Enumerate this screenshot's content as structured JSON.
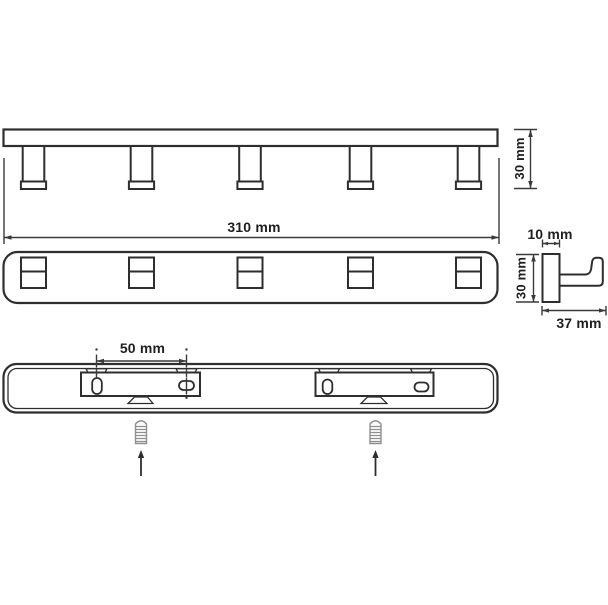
{
  "page": {
    "background": "#ffffff",
    "line_color": "#2e2e2e",
    "text_color": "#1f1f1f",
    "screw_color": "#909090"
  },
  "views": {
    "side": {
      "name": "rail side view with hooks",
      "hook_count": 5,
      "length_label": "310 mm",
      "height_label": "30 mm"
    },
    "front": {
      "name": "rail front view",
      "hook_count": 5
    },
    "hook_profile": {
      "name": "single hook profile",
      "width_label": "10 mm",
      "height_label": "30 mm",
      "depth_label": "37 mm"
    },
    "back": {
      "name": "rail back view with mounting plates",
      "slot_spacing_label": "50 mm",
      "screw_count": 2
    }
  }
}
